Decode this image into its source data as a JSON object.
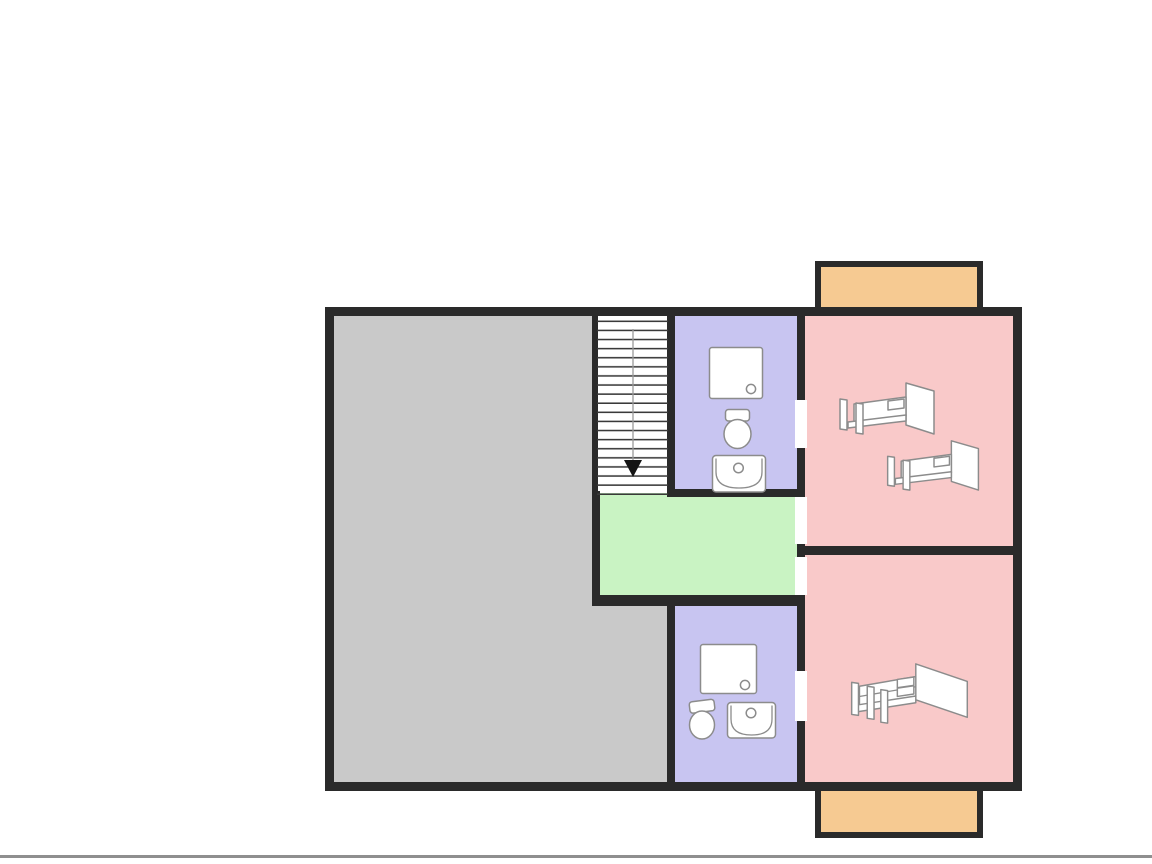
{
  "image": {
    "width": 1152,
    "height": 864,
    "background": "#ffffff"
  },
  "palette": {
    "wall": "#2a2a2a",
    "room_gray": "#c9c9c9",
    "room_purple": "#c8c5f1",
    "room_pink": "#f9c9c9",
    "room_green": "#c9f3c3",
    "balcony_orange": "#f6ca92",
    "fixture_stroke": "#8c8c8c",
    "stair_line": "#3a3a3a",
    "frame_line": "#8f8f8f"
  },
  "floor_plan": {
    "kind": "floor-plan-diagram",
    "visible_text": "",
    "rooms": [
      {
        "id": "large-room",
        "color_key": "room_gray",
        "fixtures": []
      },
      {
        "id": "staircase",
        "color_key": "white",
        "fixtures": [
          {
            "type": "stairs",
            "direction": "down",
            "treads": 19
          }
        ]
      },
      {
        "id": "bathroom-top",
        "color_key": "room_purple",
        "fixtures": [
          {
            "type": "shower"
          },
          {
            "type": "toilet"
          },
          {
            "type": "sink"
          }
        ]
      },
      {
        "id": "landing",
        "color_key": "room_green",
        "fixtures": []
      },
      {
        "id": "bathroom-bottom",
        "color_key": "room_purple",
        "fixtures": [
          {
            "type": "shower"
          },
          {
            "type": "toilet"
          },
          {
            "type": "sink"
          }
        ]
      },
      {
        "id": "bedroom-top",
        "color_key": "room_pink",
        "fixtures": [
          {
            "type": "single-bed"
          },
          {
            "type": "single-bed"
          }
        ]
      },
      {
        "id": "bedroom-bottom",
        "color_key": "room_pink",
        "fixtures": [
          {
            "type": "double-bed"
          }
        ]
      },
      {
        "id": "balcony-top",
        "color_key": "balcony_orange",
        "fixtures": []
      },
      {
        "id": "balcony-bottom",
        "color_key": "balcony_orange",
        "fixtures": []
      }
    ],
    "door_openings": [
      {
        "between": [
          "bathroom-top",
          "bedroom-top"
        ]
      },
      {
        "between": [
          "landing",
          "bedroom-top"
        ]
      },
      {
        "between": [
          "landing",
          "bedroom-bottom"
        ]
      },
      {
        "between": [
          "bathroom-bottom",
          "bedroom-bottom"
        ]
      }
    ]
  }
}
